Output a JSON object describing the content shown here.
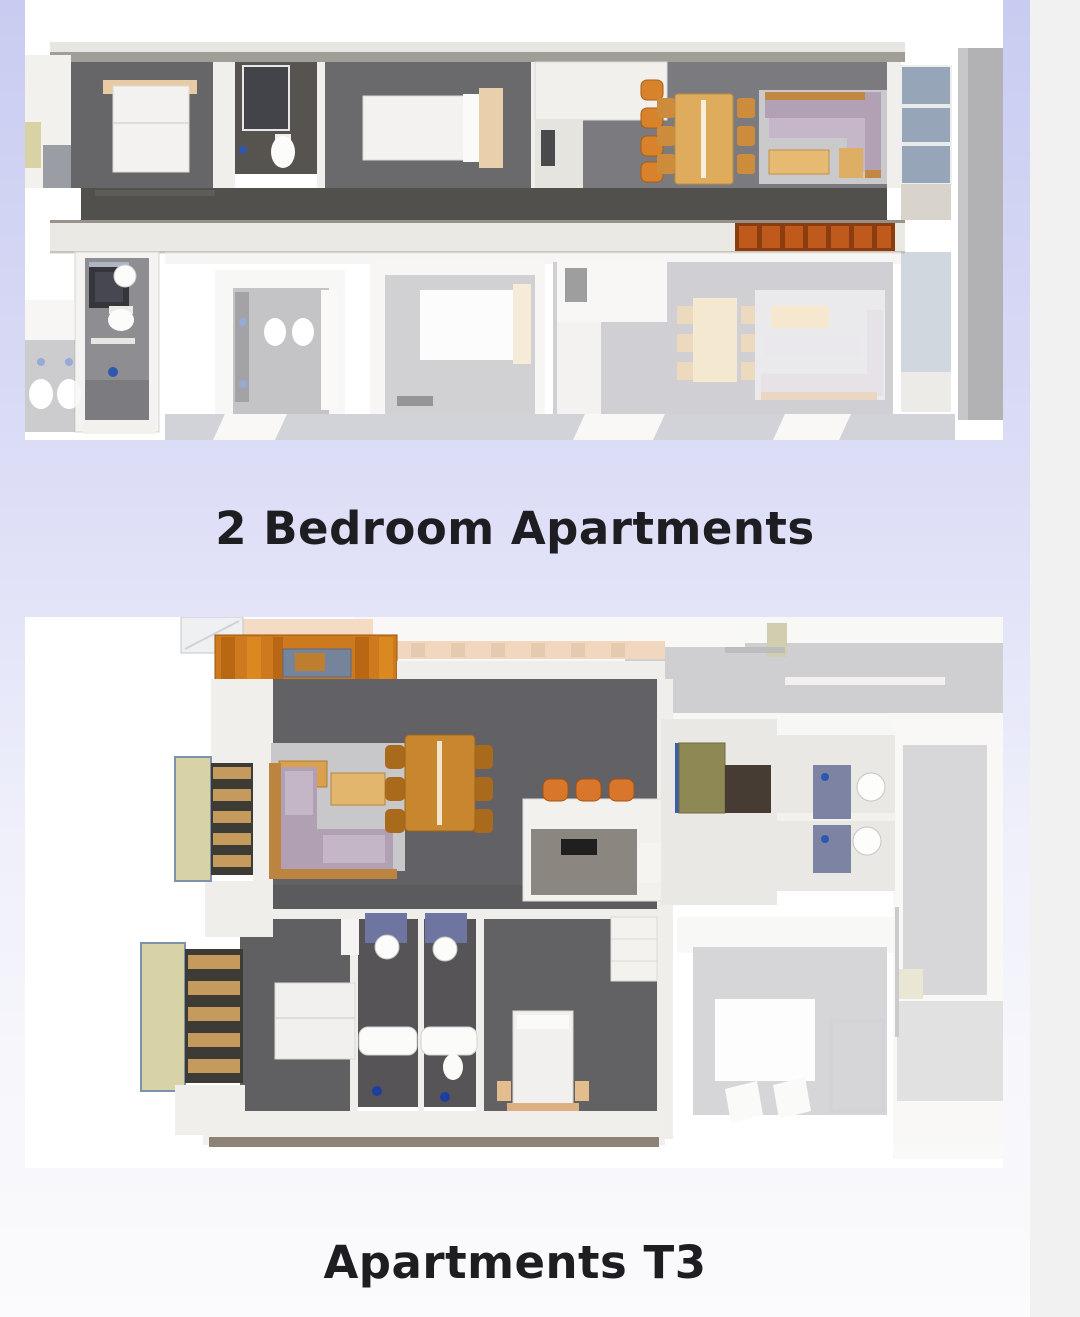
{
  "page": {
    "background": {
      "gradient_top": "#c8ccf0",
      "gradient_middle": "#e2e3f8",
      "gradient_bottom": "#fbfbfd",
      "right_gutter": "#f1f1f2"
    },
    "heading_color": "#1d1d22",
    "plan_colors": {
      "dark_floor": "#646366",
      "corridor_floor": "#52504c",
      "faded_floor": "#a6a9b2",
      "wall_white": "#f0efeb",
      "wood": "#dfab5d",
      "pergola_orange": "#cd7a1e",
      "bench_orange": "#b5541b",
      "sofa_mauve": "#b2a1b4",
      "balcony_glass": "#97a5b8",
      "accent_blue": "#2e57b0",
      "shutter_khaki": "#d8d2a7"
    }
  },
  "sections": [
    {
      "caption": "2 Bedroom Apartments"
    },
    {
      "caption": "Apartments T3"
    }
  ]
}
